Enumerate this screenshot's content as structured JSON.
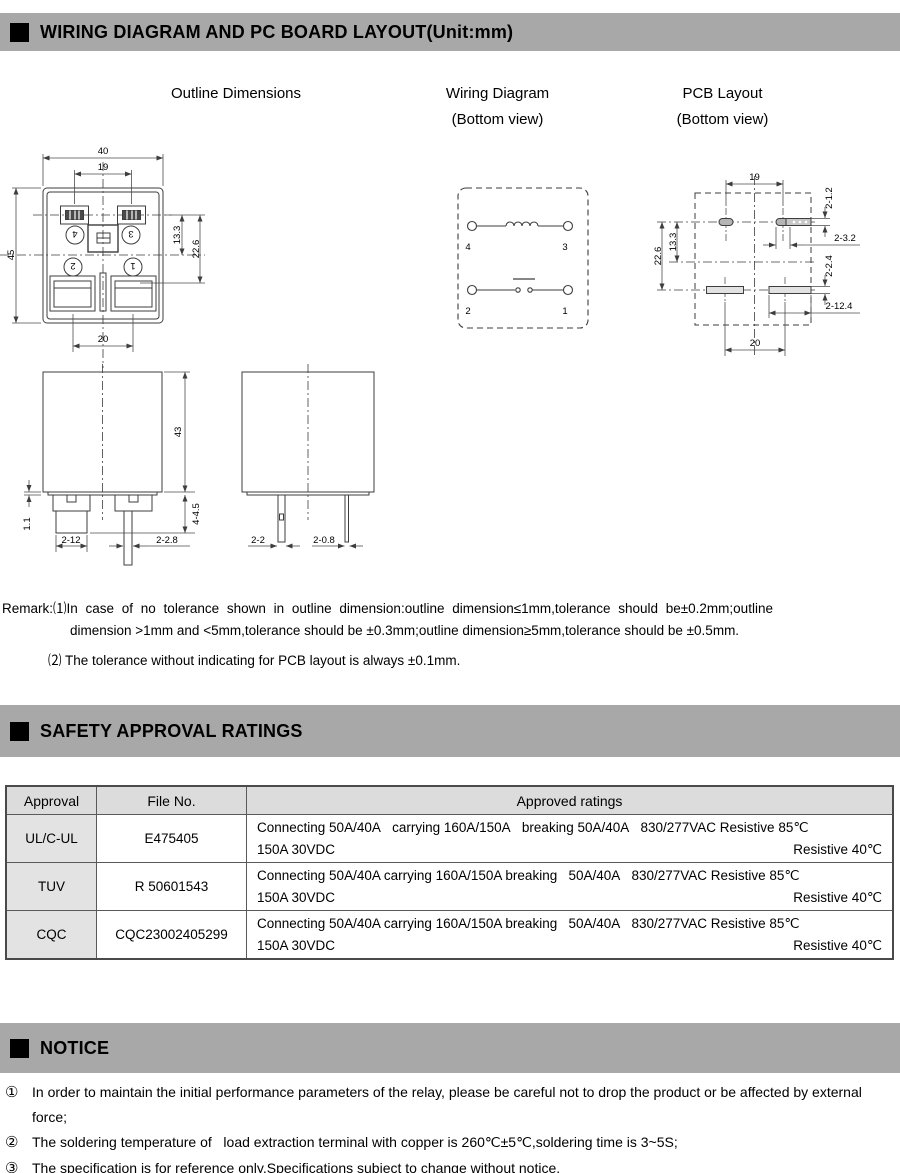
{
  "colors": {
    "bar_bg": "#a8a8a8",
    "table_header_bg": "#dcdcdc",
    "approval_cell_bg": "#e3e3e3",
    "line": "#3d3d3d"
  },
  "header_bars": {
    "wiring": "WIRING DIAGRAM AND PC BOARD LAYOUT(Unit:mm)",
    "safety": "SAFETY APPROVAL RATINGS",
    "notice": "NOTICE"
  },
  "column_titles": {
    "outline": "Outline Dimensions",
    "wiring_title": "Wiring Diagram",
    "wiring_sub": "(Bottom view)",
    "pcb_title": "PCB Layout",
    "pcb_sub": "(Bottom view)"
  },
  "outline_view": {
    "dim_top_width": "40",
    "dim_pin_spacing": "19",
    "dim_height": "45",
    "dim_coil_offset": "13.3",
    "dim_contact_offset": "22.6",
    "dim_bottom_spacing": "20",
    "terminal_4": "4",
    "terminal_3": "3",
    "terminal_2": "2",
    "terminal_1": "1"
  },
  "side_view": {
    "dim_lip": "1.1",
    "dim_body_height": "43",
    "dim_foot_height": "4-4.5",
    "dim_blade_width": "2-12",
    "dim_pin_width": "2-2.8",
    "dim_coil_pin": "2-2",
    "dim_thin_pin": "2-0.8"
  },
  "wiring_view": {
    "terminal_4": "4",
    "terminal_3": "3",
    "terminal_2": "2",
    "terminal_1": "1"
  },
  "pcb_view": {
    "dim_top_spacing": "19",
    "dim_hole_coil": "2-1.2",
    "dim_hole_len": "2-3.2",
    "dim_slot_width": "2-2.4",
    "dim_slot_length": "2-12.4",
    "dim_v_contact": "22.6",
    "dim_v_coil": "13.3",
    "dim_bottom_spacing": "20"
  },
  "remark": {
    "line1": "Remark:⑴In case of no tolerance shown in outline dimension:outline dimension≤1mm,tolerance should be±0.2mm;outline",
    "line2": "dimension >1mm and <5mm,tolerance should be ±0.3mm;outline dimension≥5mm,tolerance should be ±0.5mm.",
    "line3": "⑵ The tolerance without indicating for PCB layout is always ±0.1mm."
  },
  "table": {
    "headers": [
      "Approval",
      "File No.",
      "Approved ratings"
    ],
    "rows": [
      {
        "approval": "UL/C-UL",
        "file_no": "E475405",
        "rating_line1": "Connecting 50A/40A   carrying 160A/150A   breaking 50A/40A   830/277VAC Resistive 85℃",
        "rating_line2_left": "150A 30VDC",
        "rating_line2_right": "Resistive 40℃"
      },
      {
        "approval": "TUV",
        "file_no": "R 50601543",
        "rating_line1": "Connecting 50A/40A carrying 160A/150A breaking   50A/40A   830/277VAC Resistive 85℃",
        "rating_line2_left": "150A 30VDC",
        "rating_line2_right": "Resistive 40℃"
      },
      {
        "approval": "CQC",
        "file_no": "CQC23002405299",
        "rating_line1": "Connecting 50A/40A carrying 160A/150A breaking   50A/40A   830/277VAC Resistive 85℃",
        "rating_line2_left": "150A 30VDC",
        "rating_line2_right": "Resistive 40℃"
      }
    ]
  },
  "notices": [
    {
      "bullet": "①",
      "text": "In order to maintain the initial performance parameters of the relay, please be careful not to drop the product or be affected by external force;"
    },
    {
      "bullet": "②",
      "text": "The soldering temperature of   load extraction terminal with copper is 260℃±5℃,soldering time is 3~5S;"
    },
    {
      "bullet": "③",
      "text": "The specification is for reference only.Specifications subject to change without notice."
    }
  ]
}
